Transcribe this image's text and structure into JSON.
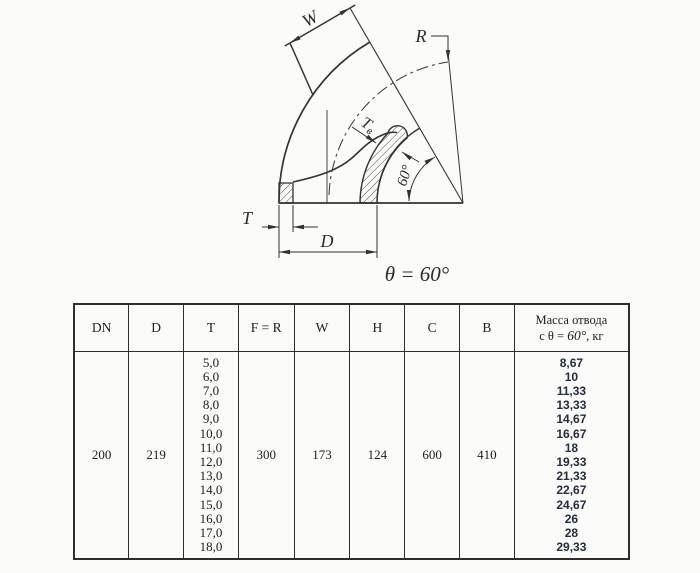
{
  "drawing": {
    "w_label": "W",
    "r_label": "R",
    "t_label": "T",
    "d_label": "D",
    "tv_label_main": "T",
    "tv_label_sub": "в",
    "angle_label": "60°",
    "theta_caption": "θ = 60°",
    "line_color": "#333333"
  },
  "table": {
    "headers": [
      "DN",
      "D",
      "T",
      "F = R",
      "W",
      "H",
      "C",
      "B"
    ],
    "mass_header": {
      "line1": "Масса отвода",
      "prefix": "с θ = ",
      "angle": "60°",
      "suffix": ", кг"
    },
    "row": {
      "dn": "200",
      "d": "219",
      "t_values": [
        "5,0",
        "6,0",
        "7,0",
        "8,0",
        "9,0",
        "10,0",
        "11,0",
        "12,0",
        "13,0",
        "14,0",
        "15,0",
        "16,0",
        "17,0",
        "18,0"
      ],
      "f_r": "300",
      "w": "173",
      "h": "124",
      "c": "600",
      "b": "410",
      "mass_values": [
        "8,67",
        "10",
        "11,33",
        "13,33",
        "14,67",
        "16,67",
        "18",
        "19,33",
        "21,33",
        "22,67",
        "24,67",
        "26",
        "28",
        "29,33"
      ],
      "mass_color": "#232c3d"
    }
  }
}
